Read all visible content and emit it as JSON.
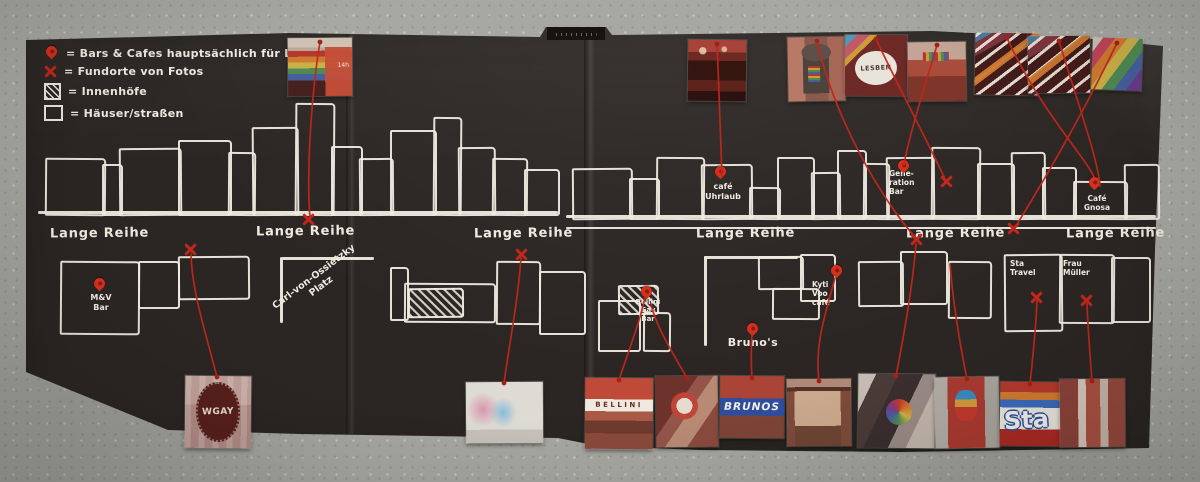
{
  "colors": {
    "concrete": "#a8a8a3",
    "paper": "#2b2623",
    "chalk": "#efeae0",
    "thread_red": "#c1271b",
    "pin_red": "#d6301d",
    "brunos_blue": "#2f4d9e"
  },
  "legend": {
    "items": [
      {
        "icon": "pin-icon",
        "label": "= Bars & Cafes hauptsächlich für LGBTQ+"
      },
      {
        "icon": "x-icon",
        "label": "= Fundorte von Fotos"
      },
      {
        "icon": "hatched-square-icon",
        "label": "= Innenhöfe"
      },
      {
        "icon": "square-icon",
        "label": "= Häuser/straßen"
      }
    ]
  },
  "street": {
    "label": "Lange Reihe"
  },
  "labels": {
    "cafe_uhrlaub": "café\nUhrlaub",
    "generation_bar": "Gene-\nration\nBar",
    "cafe_gnosa": "Café\nGnosa",
    "mv_bar": "M&V\nBar",
    "brunos": "Bruno's",
    "kyti_voo_cafe": "Kyti\nVoo\ncafé",
    "bellini_gay_bar": "Bellini\nGay\nBar",
    "sta_travel": "Sta\nTravel",
    "frau_mueller": "Frau\nMüller",
    "platz": "Carl-von-Ossietzky\nPlatz"
  },
  "photo_texts": {
    "lesben": "LESBEN",
    "wgay": "WGAY",
    "bellini": "BELLINI",
    "brunos": "BRUNOS",
    "sta": "Sta",
    "p1_dates": "14h"
  }
}
